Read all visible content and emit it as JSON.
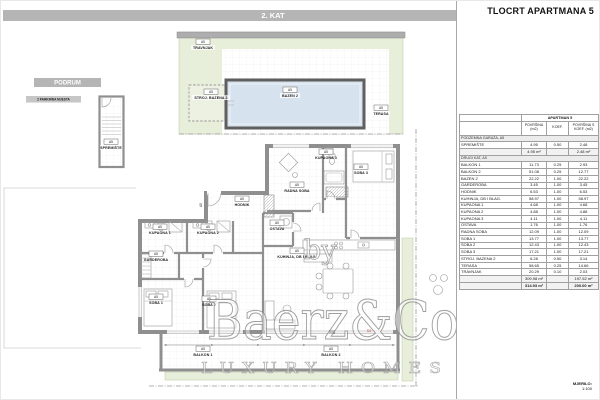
{
  "title": "TLOCRT APARTMANA 5",
  "banners": {
    "floor": "2. KAT",
    "basement": "PODRUM",
    "parking": "2 PARKIRNA MJESTA"
  },
  "unit_tag": "A5",
  "door_tag": "D3",
  "scale": {
    "label": "MJERILO:",
    "value": "1:100"
  },
  "watermark": {
    "by": "by",
    "brand": "Baerz&Co",
    "tagline": "LUXURY HOMES"
  },
  "plan_labels": {
    "travnjak": "TRAVNJAK",
    "stroj_bazena": "STROJ. BAZENA 2",
    "bazen": "BAZEN 2",
    "terasa": "TERASA",
    "radna_soba": "RADNA SOBA",
    "kupaona3": "KUPAONA 3",
    "soba3": "SOBA 3",
    "hodnik": "HODNIK",
    "ostava": "OSTAVA",
    "kupaona1": "KUPAONA 1",
    "kupaona2": "KUPAONA 2",
    "garderoba": "GARDEROBA",
    "soba1": "SOBA 1",
    "soba2": "SOBA 2",
    "kuhinja": "KUHINJA, DB I BLAG.",
    "balkon1": "BALKON 1",
    "balkon2": "BALKON 2",
    "spremiste": "SPREMIŠTE"
  },
  "table": {
    "header": {
      "apartment": "APARTMAN 5",
      "col_area": "POVRŠINA (m2)",
      "col_koef": "KOEF.",
      "col_area_koef": "POVRŠINA S KOEF. (m2)"
    },
    "sections": [
      {
        "name": "PODZEMNA GARAŽA, A5",
        "rows": [
          {
            "label": "SPREMIŠTE",
            "area": "4.95",
            "koef": "0.50",
            "area_koef": "2.48"
          }
        ],
        "subtotal": {
          "area": "4.95 m²",
          "area_koef": "2.48 m²"
        }
      },
      {
        "name": "DRUGI KAT, A5",
        "rows": [
          {
            "label": "BALKON 1",
            "area": "11.73",
            "koef": "0.25",
            "area_koef": "2.93"
          },
          {
            "label": "BALKON 2",
            "area": "51.08",
            "koef": "0.25",
            "area_koef": "12.77"
          },
          {
            "label": "BAZEN 2",
            "area": "22.22",
            "koef": "1.00",
            "area_koef": "22.22"
          },
          {
            "label": "GARDEROBA",
            "area": "3.45",
            "koef": "1.00",
            "area_koef": "3.45"
          },
          {
            "label": "HODNIK",
            "area": "6.53",
            "koef": "1.00",
            "area_koef": "6.53"
          },
          {
            "label": "KUHINJA, DB I BLAG.",
            "area": "58.97",
            "koef": "1.00",
            "area_koef": "58.97"
          },
          {
            "label": "KUPAONA 1",
            "area": "4.68",
            "koef": "1.00",
            "area_koef": "4.68"
          },
          {
            "label": "KUPAONA 2",
            "area": "4.88",
            "koef": "1.00",
            "area_koef": "4.88"
          },
          {
            "label": "KUPAONA 3",
            "area": "4.11",
            "koef": "1.00",
            "area_koef": "4.11"
          },
          {
            "label": "OSTAVA",
            "area": "1.76",
            "koef": "1.00",
            "area_koef": "1.76"
          },
          {
            "label": "RADNA SOBA",
            "area": "12.09",
            "koef": "1.00",
            "area_koef": "12.09"
          },
          {
            "label": "SOBA 1",
            "area": "13.77",
            "koef": "1.00",
            "area_koef": "13.77"
          },
          {
            "label": "SOBA 2",
            "area": "12.43",
            "koef": "1.00",
            "area_koef": "12.43"
          },
          {
            "label": "SOBA 3",
            "area": "17.21",
            "koef": "1.00",
            "area_koef": "17.21"
          },
          {
            "label": "STROJ. BAZENA 2",
            "area": "6.28",
            "koef": "0.50",
            "area_koef": "3.14"
          },
          {
            "label": "TERASA",
            "area": "58.65",
            "koef": "0.25",
            "area_koef": "14.66"
          },
          {
            "label": "TRAVNJAK",
            "area": "20.29",
            "koef": "0.10",
            "area_koef": "2.03"
          }
        ],
        "subtotal": {
          "area": "309.98 m²",
          "area_koef": "197.52 m²"
        }
      }
    ],
    "total": {
      "area": "314.93 m²",
      "area_koef": "200.00 m²"
    }
  },
  "colors": {
    "banner_gray": "#b5b5b5",
    "wall_gray": "#8f8f8f",
    "lawn_green": "#e7eed9",
    "pool_blue": "#d6e2ee",
    "door_tag_red": "#c0392b"
  }
}
